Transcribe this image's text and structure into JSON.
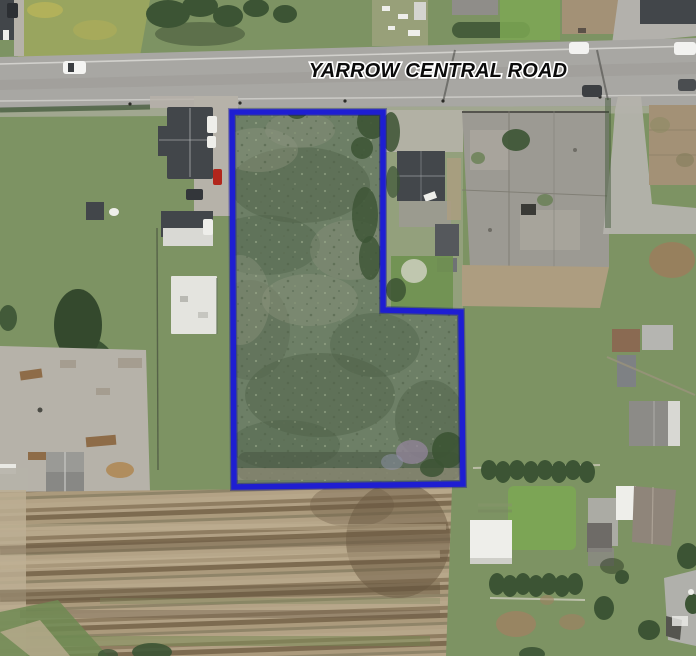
{
  "scene": {
    "road_label": "YARROW CENTRAL ROAD"
  },
  "boundary": {
    "points": "232,112 383,112 383,310 461,312 463,484 234,487",
    "stroke_width": 5.5
  },
  "colors": {
    "boundary_blue": "#1e1ed2",
    "boundary_edge": "#000090",
    "road": "#a8a7a3",
    "road_line": "#dddcd8",
    "grass": "#7d9363",
    "grass_bright": "#7ca753",
    "meadow": "#6d7f66",
    "meadow_dark": "#4e6148",
    "meadow_light": "#8e9680",
    "field_tan": "#b0a083",
    "field_brown": "#8a7a5e",
    "field_dark": "#6e5d45",
    "gravel": "#b6b2a9",
    "concrete": "#9c9a93",
    "scrub": "#ad9d80",
    "roof_dark": "#42464a",
    "roof_gray": "#8f8d89",
    "white_bldg": "#eeeeea",
    "tree": "#3c5434",
    "tan_roof": "#a39176",
    "dirt": "#9a7e5c",
    "label_text": "#0a0a0a",
    "label_halo": "#ffffff"
  }
}
